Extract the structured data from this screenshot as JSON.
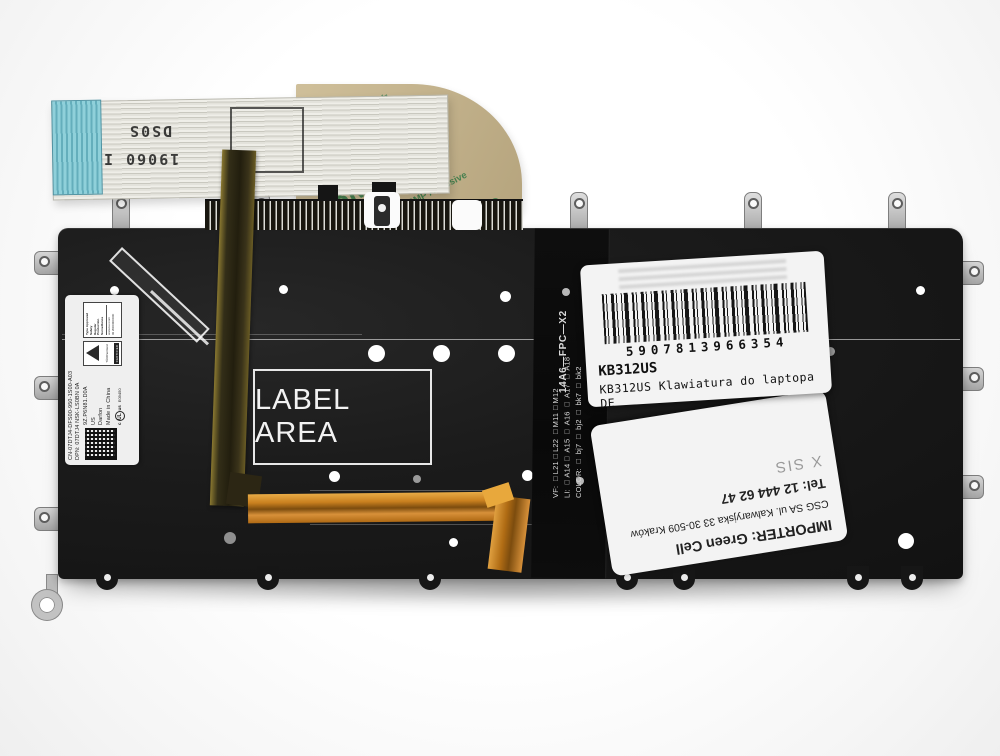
{
  "ribbon": {
    "marking_top": "DS0S",
    "marking_bottom": "19060 I"
  },
  "tape": {
    "brand": "3M",
    "code": "467MP",
    "adhesive": "200MP Adhesive"
  },
  "plate": {
    "stencil": "LABEL AREA"
  },
  "fpc": {
    "id": "14A6—FPC—X2",
    "vf_line": "VF: □L21□L22 □M11□M12",
    "li_line": "LI: □A14□ A15 □ A16 □ A17 □ A18",
    "color_line": "COLOR: □ bj7 □ bj2 □ bk7 □ bk2"
  },
  "dell_label": {
    "serial_line": "CN-07DTJ4-DFS00-950-1S00-A03",
    "dpn_line": "DPN: 07DTJ4  NSK-LS0BN  0A",
    "model_line": "9Z.P6N81.D0A",
    "region": "US",
    "maker": "Darfon",
    "origin": "Made in China",
    "ul_prefix": "c",
    "ul_text": "UL",
    "ul_suffix": "us",
    "ul_number": "E09450",
    "tuv_name": "TÜVRheinland",
    "tuv_certified": "CERTIFIED",
    "tuv_line1": "Type Approved",
    "tuv_line2": "Safety",
    "tuv_line3": "Regular",
    "tuv_line4": "Production",
    "tuv_line5": "Surveillance",
    "tuv_site": "www.tuv.com",
    "tuv_id": "ID 2000000000"
  },
  "barcode_label": {
    "number": "5907813966354",
    "sku": "KB312US",
    "description": "KB312US Klawiatura do laptopa DE"
  },
  "importer_label": {
    "importer": "IMPORTER: Green Cell",
    "address": "CSG SA ul. Kalwaryjska 33 30-509 Kraków",
    "phone": "Tel: 12 444 62 47",
    "stamp": "X SIS"
  }
}
